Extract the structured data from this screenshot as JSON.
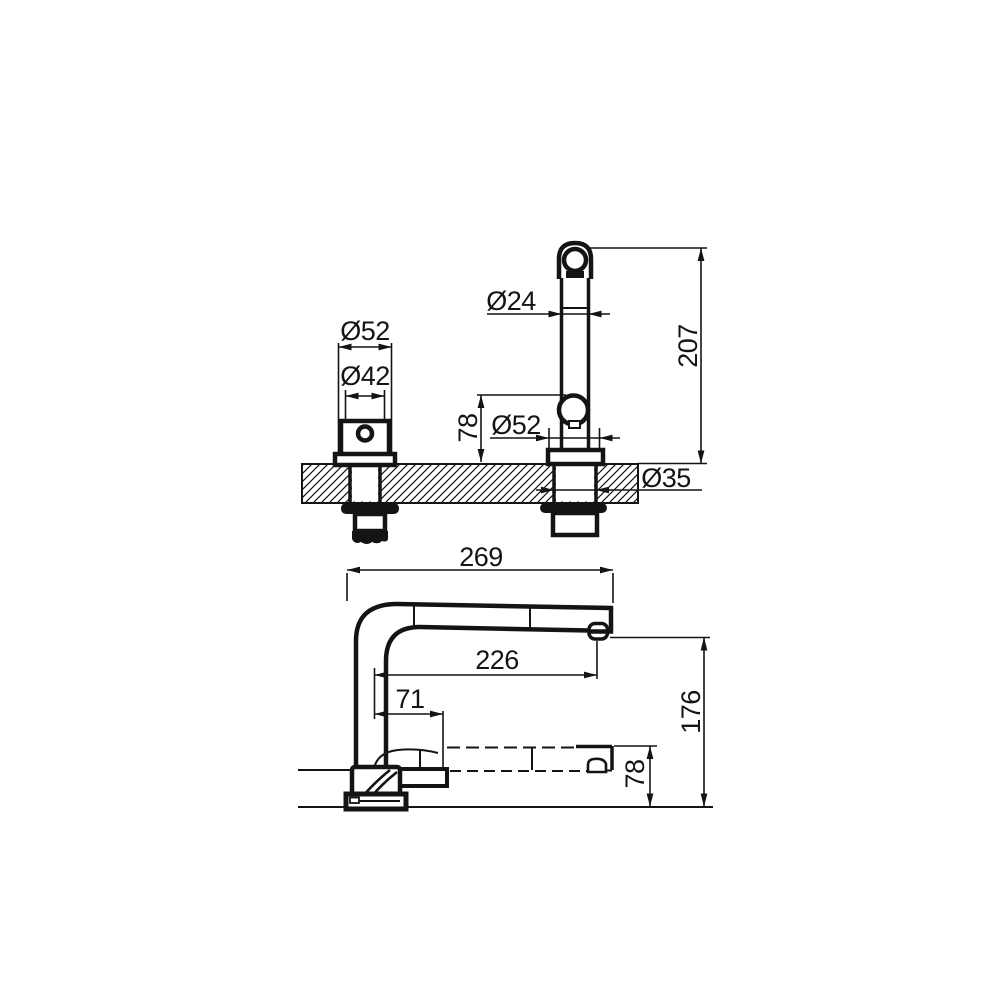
{
  "drawing": {
    "background": "#ffffff",
    "line_color": "#141414",
    "type": "faucet installation dimension drawing",
    "views": {
      "top": "front-elevation-with-counter-section",
      "bottom": "side-profile-with-pullout-spout"
    }
  },
  "dims": {
    "handle_outer_dia": "Ø52",
    "handle_body_dia": "Ø42",
    "spout_tube_dia": "Ø24",
    "ball_joint_height": "78",
    "spout_base_dia": "Ø52",
    "mounting_shank_dia": "Ø35",
    "spout_height_above_deck": "207",
    "overall_length": "269",
    "spout_reach": "226",
    "holder_offset": "71",
    "overall_height": "176",
    "lowered_spout_height": "78"
  }
}
